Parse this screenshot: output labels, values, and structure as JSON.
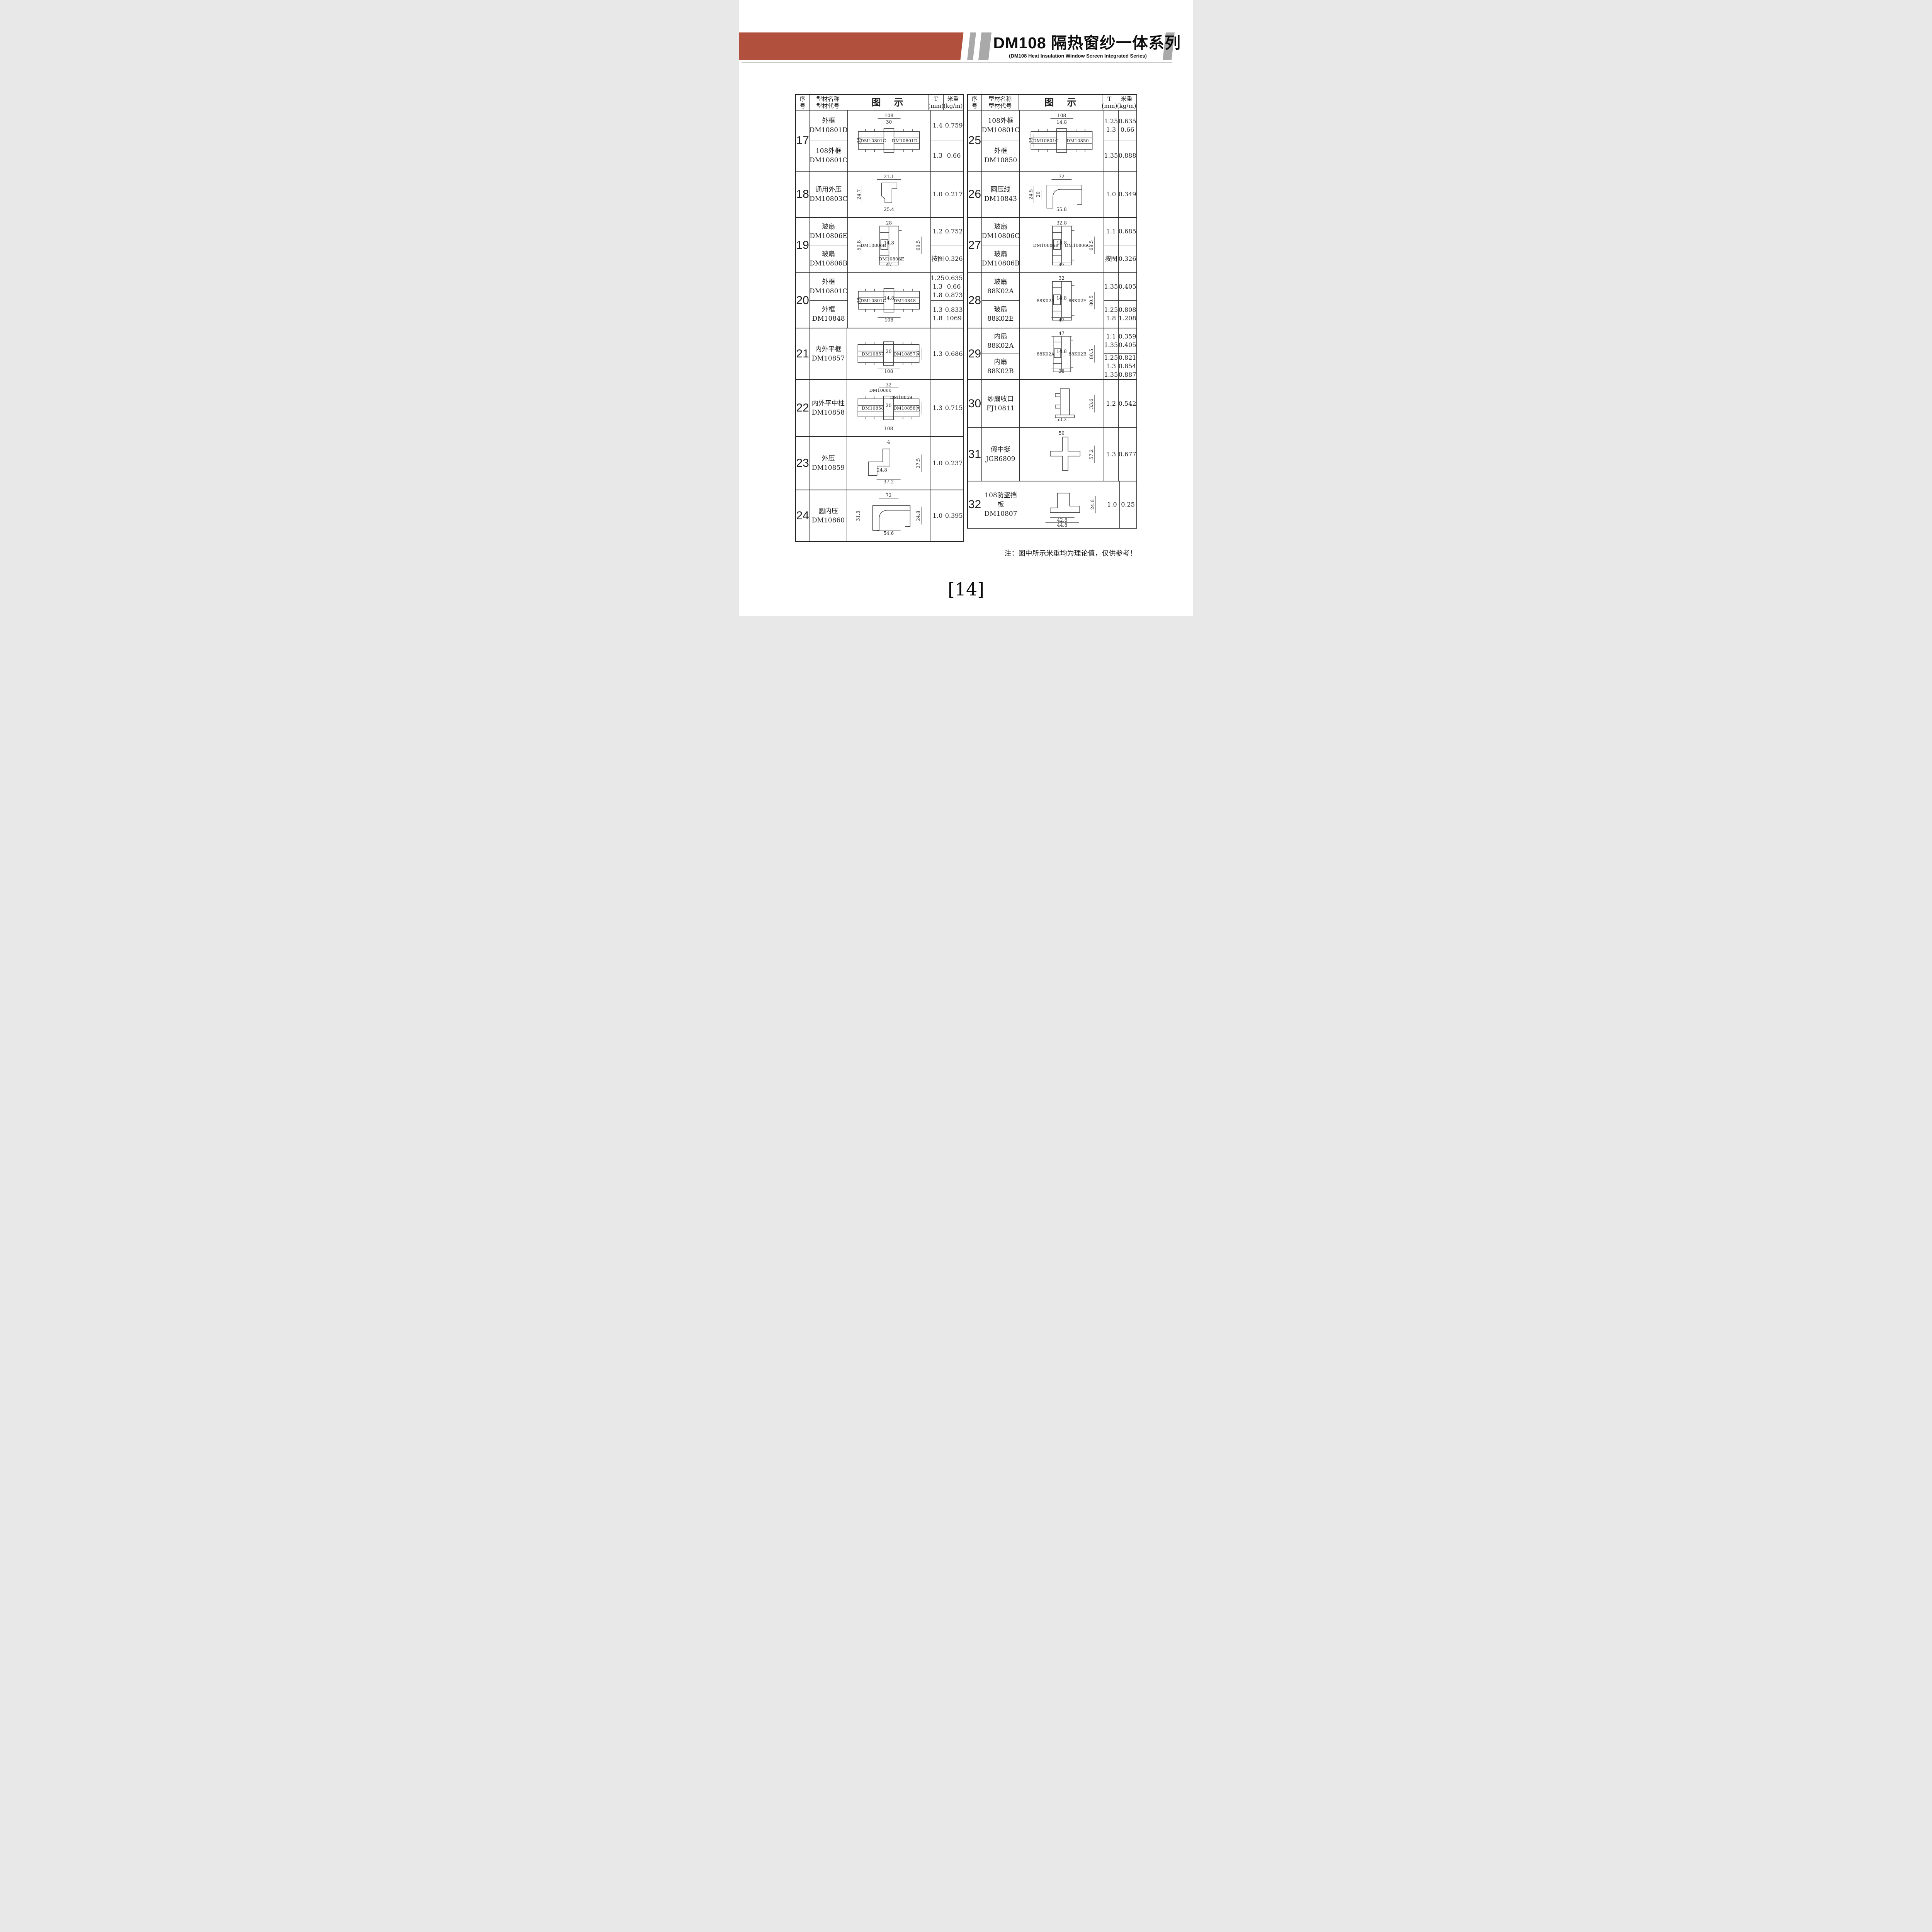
{
  "header": {
    "title": "DM108 隔热窗纱一体系列",
    "subtitle": "(DM108 Heat Insulation Window Screen Integrated Series)",
    "accent_color": "#B2503E",
    "stripe_color": "#A9A9A9"
  },
  "columns": {
    "no": "序\n号",
    "name": "型材名称\n型材代号",
    "diagram": "图示",
    "t": "T\n(mm)",
    "w": "米重\n(kg/m)"
  },
  "left_rows": [
    {
      "no": "17",
      "h": 158,
      "subs": [
        {
          "name": "外框",
          "code": "DM10801D",
          "t": "1.4",
          "w": "0.759"
        },
        {
          "name": "108外框",
          "code": "DM10801C",
          "t": "1.3",
          "w": "0.66"
        }
      ],
      "diagram": {
        "shape": "framePairH",
        "dims": [
          {
            "cls": "dim-top",
            "text": "108"
          },
          {
            "cls": "dim-top2",
            "text": "30"
          },
          {
            "cls": "dim-left",
            "text": "38"
          }
        ],
        "labels": [
          {
            "cls": "lab-left",
            "text": "DM10801C"
          },
          {
            "cls": "lab-right",
            "text": "DM10801D"
          }
        ]
      }
    },
    {
      "no": "18",
      "h": 120,
      "subs": [
        {
          "name": "通用外压",
          "code": "DM10803C",
          "t": "1.0",
          "w": "0.217"
        }
      ],
      "diagram": {
        "shape": "clipC",
        "dims": [
          {
            "cls": "dim-top",
            "text": "21.1"
          },
          {
            "cls": "dim-left",
            "text": "24.7"
          },
          {
            "cls": "dim-bottom",
            "text": "25.4"
          }
        ],
        "labels": []
      }
    },
    {
      "no": "19",
      "h": 143,
      "subs": [
        {
          "name": "玻扇",
          "code": "DM10806E",
          "t": "1.2",
          "w": "0.752"
        },
        {
          "name": "玻扇",
          "code": "DM10806B",
          "t": "按图",
          "w": "0.326"
        }
      ],
      "diagram": {
        "shape": "sashPairV",
        "dims": [
          {
            "cls": "dim-top",
            "text": "28"
          },
          {
            "cls": "dim-left",
            "text": "50.8"
          },
          {
            "cls": "dim-inner",
            "text": "14.8"
          },
          {
            "cls": "dim-right",
            "text": "69.5"
          },
          {
            "cls": "dim-bottom",
            "text": "47"
          }
        ],
        "labels": [
          {
            "cls": "lab-left",
            "text": "DM10806B"
          },
          {
            "cls": "lab-bottom",
            "text": "DM10806E"
          }
        ]
      }
    },
    {
      "no": "20",
      "h": 143,
      "subs": [
        {
          "name": "外框",
          "code": "DM10801C",
          "t": "1.25\n1.3\n1.8",
          "w": "0.635\n0.66\n0.873"
        },
        {
          "name": "外框",
          "code": "DM10848",
          "t": "1.3\n1.8",
          "w": "0.833\n1069"
        }
      ],
      "diagram": {
        "shape": "framePairH",
        "dims": [
          {
            "cls": "dim-left",
            "text": "38"
          },
          {
            "cls": "dim-inner",
            "text": "14.8"
          },
          {
            "cls": "dim-bottom",
            "text": "108"
          }
        ],
        "labels": [
          {
            "cls": "lab-left",
            "text": "DM10801C"
          },
          {
            "cls": "lab-right",
            "text": "DM10848"
          }
        ]
      }
    },
    {
      "no": "21",
      "h": 133,
      "subs": [
        {
          "name": "内外平框",
          "code": "DM10857",
          "t": "1.3",
          "w": "0.686"
        }
      ],
      "diagram": {
        "shape": "framePairH",
        "dims": [
          {
            "cls": "dim-inner",
            "text": "20"
          },
          {
            "cls": "dim-right",
            "text": "38"
          },
          {
            "cls": "dim-bottom",
            "text": "108"
          }
        ],
        "labels": [
          {
            "cls": "lab-left",
            "text": "DM10857"
          },
          {
            "cls": "lab-right",
            "text": "DM10857"
          }
        ]
      }
    },
    {
      "no": "22",
      "h": 148,
      "subs": [
        {
          "name": "内外平中柱",
          "code": "DM10858",
          "t": "1.3",
          "w": "0.715"
        }
      ],
      "diagram": {
        "shape": "framePairH",
        "dims": [
          {
            "cls": "dim-top",
            "text": "32"
          },
          {
            "cls": "dim-inner",
            "text": "20"
          },
          {
            "cls": "dim-right",
            "text": "38"
          },
          {
            "cls": "dim-bottom",
            "text": "108"
          }
        ],
        "labels": [
          {
            "cls": "lab-top-left",
            "text": "DM10860"
          },
          {
            "cls": "lab-top-right",
            "text": "DM10859"
          },
          {
            "cls": "lab-left",
            "text": "DM10858"
          },
          {
            "cls": "lab-right",
            "text": "DM10858"
          }
        ]
      }
    },
    {
      "no": "23",
      "h": 138,
      "subs": [
        {
          "name": "外压",
          "code": "DM10859",
          "t": "1.0",
          "w": "0.237"
        }
      ],
      "diagram": {
        "shape": "pressL",
        "dims": [
          {
            "cls": "dim-top",
            "text": "4"
          },
          {
            "cls": "dim-right",
            "text": "27.5"
          },
          {
            "cls": "dim-mid",
            "text": "24.8"
          },
          {
            "cls": "dim-bottom",
            "text": "37.2"
          }
        ],
        "labels": []
      }
    },
    {
      "no": "24",
      "h": 131,
      "subs": [
        {
          "name": "圆内压",
          "code": "DM10860",
          "t": "1.0",
          "w": "0.395"
        }
      ],
      "diagram": {
        "shape": "cornerQ",
        "dims": [
          {
            "cls": "dim-top",
            "text": "72"
          },
          {
            "cls": "dim-left",
            "text": "31.3"
          },
          {
            "cls": "dim-right",
            "text": "24.8"
          },
          {
            "cls": "dim-bottom",
            "text": "54.6"
          }
        ],
        "labels": []
      }
    }
  ],
  "right_rows": [
    {
      "no": "25",
      "h": 158,
      "subs": [
        {
          "name": "108外框",
          "code": "DM10801C",
          "t": "1.25\n1.3",
          "w": "0.635\n0.66"
        },
        {
          "name": "外框",
          "code": "DM10850",
          "t": "1.35",
          "w": "0.888"
        }
      ],
      "diagram": {
        "shape": "framePairH",
        "dims": [
          {
            "cls": "dim-top",
            "text": "108"
          },
          {
            "cls": "dim-top2",
            "text": "14.8"
          },
          {
            "cls": "dim-left",
            "text": "38"
          }
        ],
        "labels": [
          {
            "cls": "lab-left",
            "text": "DM10801C"
          },
          {
            "cls": "lab-right",
            "text": "DM10850"
          }
        ]
      }
    },
    {
      "no": "26",
      "h": 120,
      "subs": [
        {
          "name": "圆压线",
          "code": "DM10843",
          "t": "1.0",
          "w": "0.349"
        }
      ],
      "diagram": {
        "shape": "cornerQ",
        "dims": [
          {
            "cls": "dim-top",
            "text": "72"
          },
          {
            "cls": "dim-left",
            "text": "24.5"
          },
          {
            "cls": "dim-left2",
            "text": "20"
          },
          {
            "cls": "dim-bottom",
            "text": "55.8"
          }
        ],
        "labels": []
      }
    },
    {
      "no": "27",
      "h": 143,
      "subs": [
        {
          "name": "玻扇",
          "code": "DM10806C",
          "t": "1.1",
          "w": "0.685"
        },
        {
          "name": "玻扇",
          "code": "DM10806B",
          "t": "按图",
          "w": "0.326"
        }
      ],
      "diagram": {
        "shape": "sashPairV",
        "dims": [
          {
            "cls": "dim-top",
            "text": "32.8"
          },
          {
            "cls": "dim-inner",
            "text": "14.8"
          },
          {
            "cls": "dim-right",
            "text": "69.5"
          },
          {
            "cls": "dim-bottom",
            "text": "47"
          }
        ],
        "labels": [
          {
            "cls": "lab-left",
            "text": "DM10806B"
          },
          {
            "cls": "lab-right",
            "text": "DM10806C"
          }
        ]
      }
    },
    {
      "no": "28",
      "h": 143,
      "subs": [
        {
          "name": "玻扇",
          "code": "88K02A",
          "t": "1.35",
          "w": "0.405"
        },
        {
          "name": "玻扇",
          "code": "88K02E",
          "t": "1.25\n1.8",
          "w": "0.808\n1.208"
        }
      ],
      "diagram": {
        "shape": "sashPairV",
        "dims": [
          {
            "cls": "dim-top",
            "text": "32"
          },
          {
            "cls": "dim-inner",
            "text": "14.8"
          },
          {
            "cls": "dim-right",
            "text": "80.5"
          },
          {
            "cls": "dim-bottom",
            "text": "47"
          }
        ],
        "labels": [
          {
            "cls": "lab-left",
            "text": "88K02A"
          },
          {
            "cls": "lab-right",
            "text": "88K02E"
          }
        ]
      }
    },
    {
      "no": "29",
      "h": 133,
      "subs": [
        {
          "name": "内扇",
          "code": "88K02A",
          "t": "1.1\n1.35",
          "w": "0.359\n0.405"
        },
        {
          "name": "内扇",
          "code": "88K02B",
          "t": "1.25\n1.3\n1.35",
          "w": "0.821\n0.854\n0.887"
        }
      ],
      "diagram": {
        "shape": "sashPairV",
        "dims": [
          {
            "cls": "dim-top",
            "text": "47"
          },
          {
            "cls": "dim-inner",
            "text": "14.8"
          },
          {
            "cls": "dim-right",
            "text": "80.5"
          },
          {
            "cls": "dim-bottom",
            "text": "28"
          }
        ],
        "labels": [
          {
            "cls": "lab-left",
            "text": "88K02A"
          },
          {
            "cls": "lab-right",
            "text": "88K02B"
          }
        ]
      }
    },
    {
      "no": "30",
      "h": 125,
      "subs": [
        {
          "name": "纱扇收口",
          "code": "FJ10811",
          "t": "1.2",
          "w": "0.542"
        }
      ],
      "diagram": {
        "shape": "screenEnd",
        "dims": [
          {
            "cls": "dim-right",
            "text": "33.6"
          },
          {
            "cls": "dim-bottom",
            "text": "53.2"
          }
        ],
        "labels": []
      }
    },
    {
      "no": "31",
      "h": 138,
      "subs": [
        {
          "name": "假中挺",
          "code": "JGB6809",
          "t": "1.3",
          "w": "0.677"
        }
      ],
      "diagram": {
        "shape": "falseMullion",
        "dims": [
          {
            "cls": "dim-top",
            "text": "50"
          },
          {
            "cls": "dim-right",
            "text": "57.2"
          }
        ],
        "labels": []
      }
    },
    {
      "no": "32",
      "h": 120,
      "subs": [
        {
          "name": "108防盗挡板",
          "code": "DM10807",
          "t": "1.0",
          "w": "0.25"
        }
      ],
      "diagram": {
        "shape": "guardStep",
        "dims": [
          {
            "cls": "dim-right",
            "text": "24.6"
          },
          {
            "cls": "dim-bottom",
            "text": "42.8"
          },
          {
            "cls": "dim-bottom2",
            "text": "44.8"
          }
        ],
        "labels": []
      }
    }
  ],
  "footer": {
    "note": "注：图中所示米重均为理论值，仅供参考！",
    "page_number": "[14]"
  }
}
